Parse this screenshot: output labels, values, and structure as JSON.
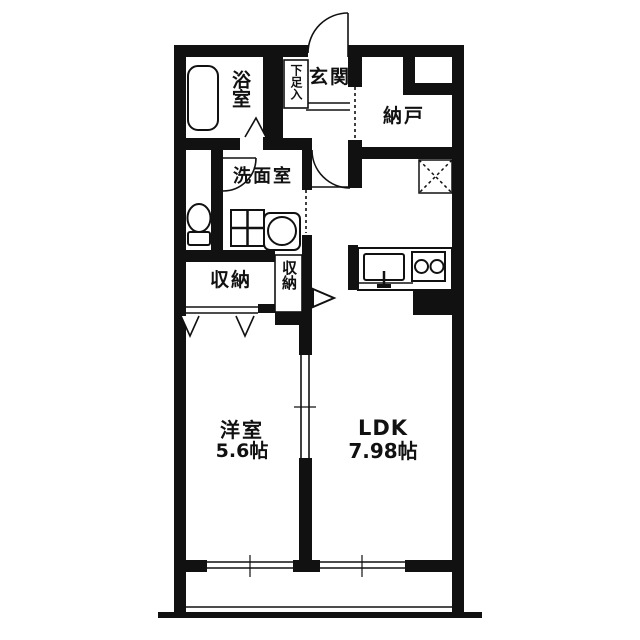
{
  "floorplan": {
    "background": "#ffffff",
    "wall_color": "#111111",
    "rooms": [
      {
        "id": "bathroom",
        "label": "浴室"
      },
      {
        "id": "shoe_cabinet",
        "label": "下足入"
      },
      {
        "id": "entrance",
        "label": "玄関"
      },
      {
        "id": "storage_room",
        "label": "納戸"
      },
      {
        "id": "washroom",
        "label": "洗面室"
      },
      {
        "id": "closet_left",
        "label": "収納"
      },
      {
        "id": "closet_middle",
        "label": "収納"
      },
      {
        "id": "western_room",
        "label": "洋室",
        "size": "5.6帖"
      },
      {
        "id": "ldk",
        "label": "LDK",
        "size": "7.98帖"
      }
    ],
    "fixtures": [
      "bathtub",
      "toilet",
      "washing-machine-pan",
      "washbasin",
      "kitchen-sink",
      "gas-stove",
      "refrigerator-space",
      "entrance-door",
      "bathroom-folding-door",
      "washroom-door",
      "ldk-door",
      "sliding-door",
      "balcony-windows"
    ]
  }
}
